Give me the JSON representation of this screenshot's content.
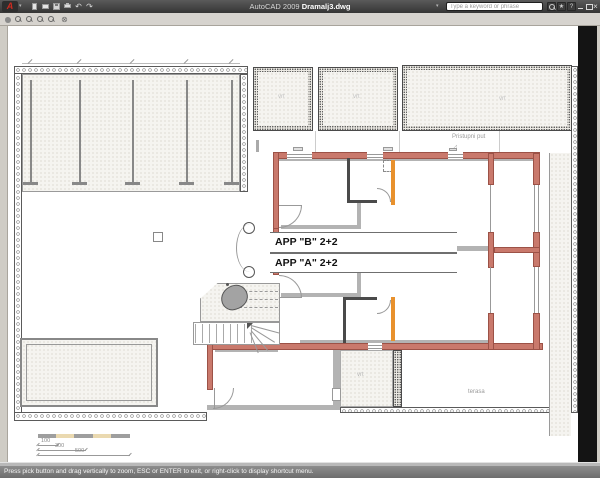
{
  "titlebar": {
    "app_name": "AutoCAD 2009",
    "doc_name": "Dramalj3.dwg",
    "search_placeholder": "Type a keyword or phrase"
  },
  "statusbar": {
    "message": "Press pick button and drag vertically to zoom, ESC or ENTER to exit, or right-click to display shortcut menu."
  },
  "plan": {
    "labels": {
      "apartment_b": "APP \"B\" 2+2",
      "apartment_a": "APP \"A\" 2+2",
      "access_road": "Pristupni put",
      "terrace": "terasa",
      "garden": "vrt"
    },
    "scale_bar": {
      "d1": "100",
      "d2": "300",
      "d3": "500"
    },
    "colors": {
      "exterior_wall": "#c9796c",
      "interior_wall": "#b3b3b3",
      "partition_wall": "#4a4a4a",
      "joinery_accent": "#e8912d",
      "scale_cream": "#ead9b0"
    }
  },
  "glyphs": {
    "logo": "A",
    "caret": "▾",
    "undo": "↶",
    "redo": "↷",
    "star": "★",
    "help": "?",
    "exit": "⊗",
    "close": "×"
  }
}
